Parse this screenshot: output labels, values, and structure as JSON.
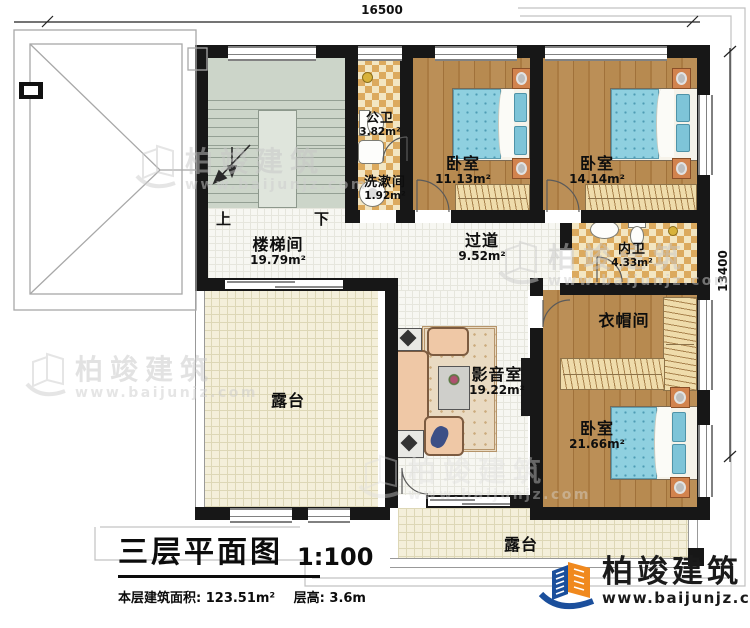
{
  "dimensions": {
    "width_top": "16500",
    "height_right": "13400"
  },
  "stairs": {
    "up": "上",
    "down": "下"
  },
  "rooms": {
    "stairwell": {
      "name": "楼梯间",
      "area": "19.79m²"
    },
    "public_bath": {
      "name": "公卫",
      "area": "3.82m²"
    },
    "washroom": {
      "name": "洗漱间",
      "area": "1.92m²"
    },
    "bedroom_small": {
      "name": "卧室",
      "area": "11.13m²"
    },
    "bedroom_mid": {
      "name": "卧室",
      "area": "14.14m²"
    },
    "ensuite_bath": {
      "name": "内卫",
      "area": "4.33m²"
    },
    "hallway": {
      "name": "过道",
      "area": "9.52m²"
    },
    "cloakroom": {
      "name": "衣帽间"
    },
    "media_room": {
      "name": "影音室",
      "area": "19.22m²"
    },
    "bedroom_large": {
      "name": "卧室",
      "area": "21.66m²"
    },
    "terrace_left": {
      "name": "露台"
    },
    "terrace_bottom": {
      "name": "露台"
    }
  },
  "title_block": {
    "title": "三层平面图",
    "scale": "1:100",
    "floor_area": "本层建筑面积: 123.51m²",
    "floor_height": "层高: 3.6m"
  },
  "brand": {
    "name": "柏竣建筑",
    "url": "www.baijunjz.com",
    "blue": "#1b4f9c",
    "orange": "#f0891e"
  },
  "watermark": {
    "name": "柏竣建筑",
    "url": "www.baijunjz.com"
  }
}
